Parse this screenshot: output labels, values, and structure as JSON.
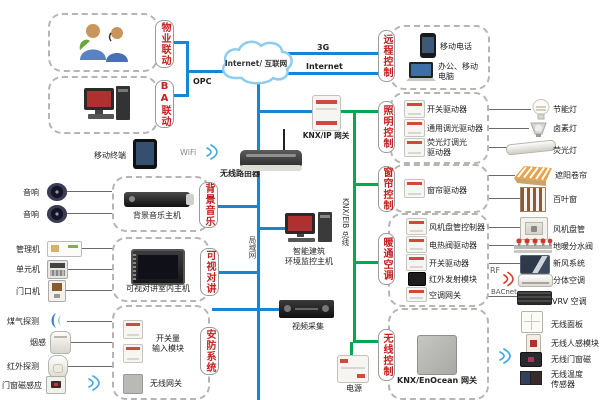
{
  "cloud": {
    "label": "Internet/ 互联网"
  },
  "net_labels": {
    "g3": "3G",
    "internet": "Internet",
    "opc": "OPC",
    "wifi": "WiFi",
    "lan": "局域网",
    "knx_bus": "KNX/EIB 总线",
    "rf": "RF",
    "bacnet": "BACnet"
  },
  "center": {
    "knx_ip_gateway": "KNX/IP 网关",
    "router": "无线路由器",
    "mobile_terminal": "移动终端",
    "monitor_host": "智能建筑\n环境监控主机",
    "video_capture": "视频采集",
    "power": "电源"
  },
  "clusters": {
    "property": {
      "tab": "物业联动"
    },
    "ba": {
      "tab": "BA联动"
    },
    "remote": {
      "tab": "远程控制",
      "devices": [
        {
          "label": "移动电话"
        },
        {
          "label": "办公、移动\n电脑"
        }
      ]
    },
    "music": {
      "tab": "背景音乐",
      "devices": [
        {
          "label": "背景音乐主机"
        }
      ]
    },
    "intercom": {
      "tab": "可视对讲",
      "devices": [
        {
          "label": "可视对讲室内主机"
        }
      ]
    },
    "security": {
      "tab": "安防系统",
      "devices": [
        {
          "label": "开关量\n输入模块"
        },
        {
          "label": "无线网关"
        }
      ]
    },
    "lighting": {
      "tab": "照明控制",
      "devices": [
        {
          "label": "开关驱动器"
        },
        {
          "label": "通用调光驱动器"
        },
        {
          "label": "荧光灯调光\n驱动器"
        }
      ]
    },
    "curtain": {
      "tab": "窗帘控制",
      "devices": [
        {
          "label": "窗帘驱动器"
        }
      ]
    },
    "hvac": {
      "tab": "暖通空调",
      "devices": [
        {
          "label": "风机盘管控制器"
        },
        {
          "label": "电热阀驱动器"
        },
        {
          "label": "开关驱动器"
        },
        {
          "label": "红外发射模块"
        },
        {
          "label": "空调网关"
        }
      ]
    },
    "wireless": {
      "tab": "无线控制",
      "devices": [
        {
          "label": "KNX/EnOcean 网关"
        }
      ]
    }
  },
  "left_devices": [
    {
      "label": "音响"
    },
    {
      "label": "音响"
    },
    {
      "label": "管理机"
    },
    {
      "label": "单元机"
    },
    {
      "label": "门口机"
    },
    {
      "label": "煤气探测"
    },
    {
      "label": "烟感"
    },
    {
      "label": "红外探测"
    },
    {
      "label": "门窗磁感应"
    }
  ],
  "right_devices": [
    {
      "label": "节能灯"
    },
    {
      "label": "卤素灯"
    },
    {
      "label": "荧光灯"
    },
    {
      "label": "遮阳卷帘"
    },
    {
      "label": "百叶窗"
    },
    {
      "label": "风机盘管"
    },
    {
      "label": "地暖分水阀"
    },
    {
      "label": "新风系统"
    },
    {
      "label": "分体空调"
    },
    {
      "label": "VRV 空调"
    },
    {
      "label": "无线面板"
    },
    {
      "label": "无线人感模块"
    },
    {
      "label": "无线门窗磁"
    },
    {
      "label": "无线温度\n传感器"
    }
  ],
  "colors": {
    "line_blue": "#1585d8",
    "bus_green": "#00a84f",
    "tab_red": "#c41f1f"
  }
}
